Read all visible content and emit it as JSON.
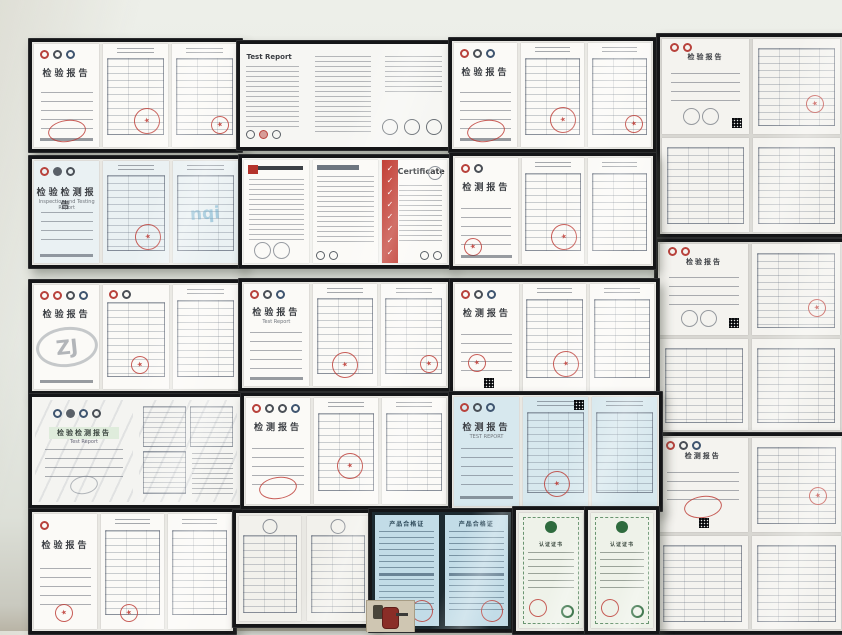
{
  "icons": {
    "star": "★",
    "check": "✓"
  },
  "colors": {
    "wall": "#e8ebe5",
    "frame": "#151618",
    "stamp_red": "#bc3630",
    "cert_stripe_red": "#c0392f",
    "cyan_paper": "#c2dce7",
    "blue_paper": "#eaf1f3",
    "green_emblem": "#2e6b3e"
  },
  "frames": {
    "f1": {
      "title": "检验报告"
    },
    "f2": {
      "title": "Test Report"
    },
    "f3": {
      "title": "检验报告"
    },
    "f4": {
      "title": "检验检测报告",
      "subtitle": "Inspection and Testing Report",
      "watermark": "nqi"
    },
    "f5": {
      "title": "Certificate",
      "checks": "✓✓✓✓✓✓✓✓"
    },
    "f6": {
      "title": "检测报告"
    },
    "f7": {
      "title": "检验报告",
      "watermark": "ZJ"
    },
    "f8": {
      "title": "检验报告",
      "subtitle": "Test Report"
    },
    "f9": {
      "title": "检测报告"
    },
    "f10": {
      "title": "检验检测报告",
      "subtitle": "Test Report"
    },
    "f11": {
      "title": "检测报告"
    },
    "f12": {
      "title": "检测报告",
      "subtitle": "TEST REPORT"
    },
    "f13": {
      "title": "检验报告"
    },
    "f14": {},
    "f15": {
      "title": "产品合格证"
    },
    "f16": {
      "title": "认证证书"
    },
    "f17": {
      "title": "认证证书"
    },
    "r1": {
      "title": "检验报告"
    },
    "r2": {
      "title": "检验报告"
    },
    "r3": {
      "title": "检测报告"
    }
  }
}
